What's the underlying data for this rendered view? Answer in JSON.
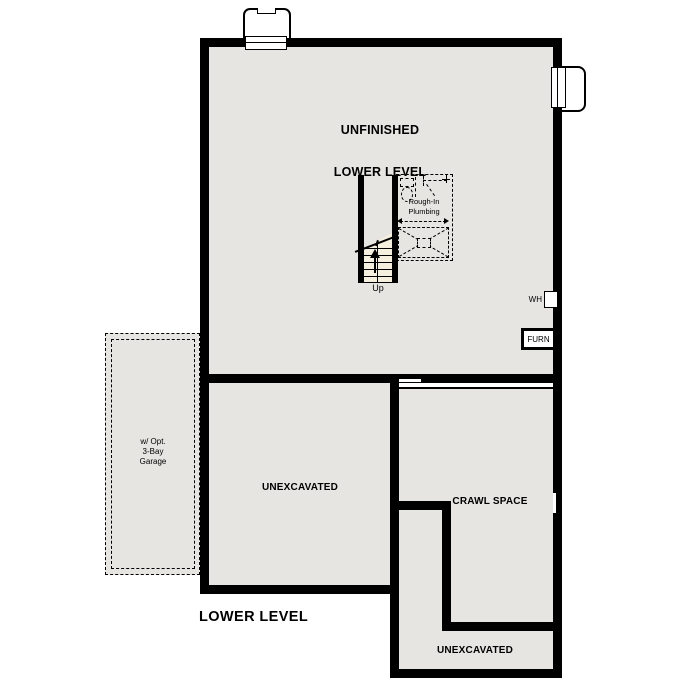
{
  "floor_plan": {
    "title": "LOWER LEVEL",
    "labels": {
      "main_room_line1": "UNFINISHED",
      "main_room_line2": "LOWER LEVEL",
      "left_room": "UNEXCAVATED",
      "crawl_space": "CRAWL SPACE",
      "bottom_room": "UNEXCAVATED",
      "garage_line1": "w/ Opt.",
      "garage_line2": "3-Bay",
      "garage_line3": "Garage",
      "plumbing_line1": "Rough-In",
      "plumbing_line2": "Plumbing",
      "stairs_up": "Up",
      "water_heater": "WH",
      "furnace": "FURN"
    },
    "colors": {
      "background": "#ffffff",
      "wall": "#000000",
      "room_fill": "#e6e5e2",
      "stair_fill": "#f5efe0"
    }
  }
}
